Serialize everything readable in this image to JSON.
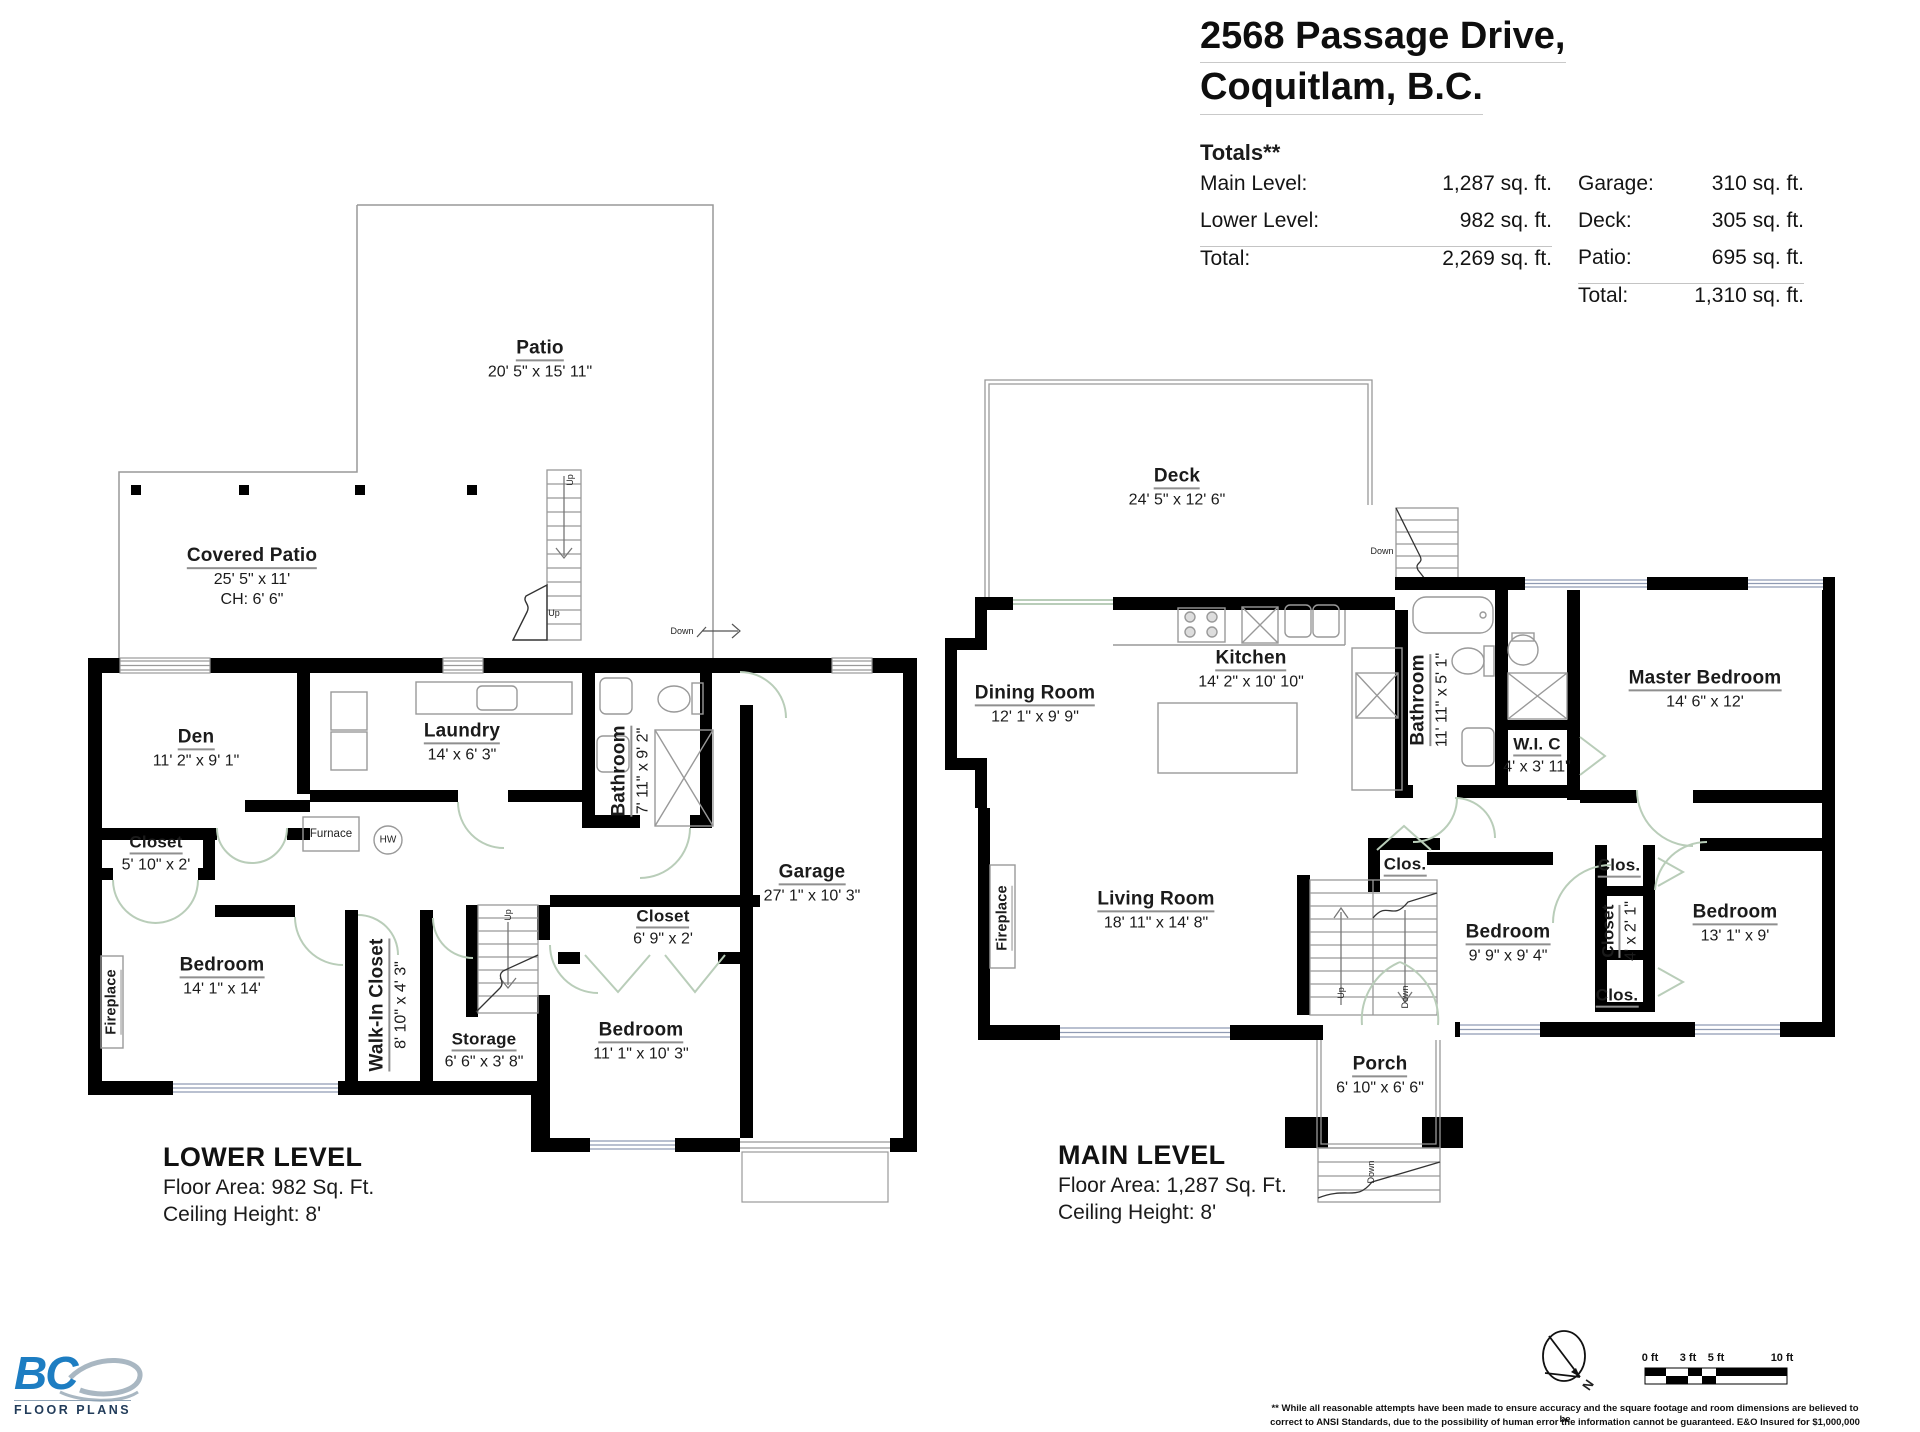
{
  "header": {
    "title_line1": "2568 Passage Drive,",
    "title_line2": "Coquitlam, B.C.",
    "totals_heading": "Totals**",
    "left_rows": [
      {
        "label": "Main Level:",
        "value": "1,287 sq. ft."
      },
      {
        "label": "Lower Level:",
        "value": "982 sq. ft."
      },
      {
        "label": "Total:",
        "value": "2,269 sq. ft."
      }
    ],
    "right_rows": [
      {
        "label": "Garage:",
        "value": "310 sq. ft."
      },
      {
        "label": "Deck:",
        "value": "305 sq. ft."
      },
      {
        "label": "Patio:",
        "value": "695 sq. ft."
      },
      {
        "label": "Total:",
        "value": "1,310 sq. ft."
      }
    ]
  },
  "labels": {
    "up": "Up",
    "down": "Down"
  },
  "lower_level": {
    "patio": {
      "name": "Patio",
      "dims": "20' 5\" x 15' 11\""
    },
    "covered_patio": {
      "name": "Covered Patio",
      "dims": "25' 5\" x 11'",
      "ceiling": "CH: 6' 6\""
    },
    "den": {
      "name": "Den",
      "dims": "11' 2\" x 9' 1\""
    },
    "closet": {
      "name": "Closet",
      "dims": "5' 10\" x 2'"
    },
    "laundry": {
      "name": "Laundry",
      "dims": "14' x 6' 3\""
    },
    "bathroom": {
      "name": "Bathroom",
      "dims": "7' 11\" x 9' 2\""
    },
    "furnace": "Furnace",
    "hot_water": "HW",
    "fireplace": "Fireplace",
    "bedroom1": {
      "name": "Bedroom",
      "dims": "14' 1\" x 14'"
    },
    "walk_in_closet": {
      "name": "Walk-In Closet",
      "dims": "8' 10\" x 4' 3\""
    },
    "storage": {
      "name": "Storage",
      "dims": "6' 6\" x 3' 8\""
    },
    "bedroom2": {
      "name": "Bedroom",
      "dims": "11' 1\" x 10' 3\""
    },
    "closet2": {
      "name": "Closet",
      "dims": "6' 9\" x 2'"
    },
    "garage": {
      "name": "Garage",
      "dims": "27' 1\" x 10' 3\""
    },
    "footer": {
      "title": "LOWER LEVEL",
      "area": "Floor Area: 982 Sq. Ft.",
      "ceiling": "Ceiling Height: 8'"
    }
  },
  "main_level": {
    "deck": {
      "name": "Deck",
      "dims": "24' 5\" x 12' 6\""
    },
    "dining_room": {
      "name": "Dining Room",
      "dims": "12' 1\" x 9' 9\""
    },
    "kitchen": {
      "name": "Kitchen",
      "dims": "14' 2\" x 10' 10\""
    },
    "bathroom": {
      "name": "Bathroom",
      "dims": "11' 11\" x 5' 1\""
    },
    "wic": {
      "name": "W.I. C",
      "dims": "4' x 3' 11\""
    },
    "master_bedroom": {
      "name": "Master Bedroom",
      "dims": "14' 6\" x 12'"
    },
    "living_room": {
      "name": "Living Room",
      "dims": "18' 11\" x 14' 8\""
    },
    "fireplace": "Fireplace",
    "clos": "Clos.",
    "closet": {
      "name": "Closet",
      "dims": "4' x 2' 1\""
    },
    "bedroom1": {
      "name": "Bedroom",
      "dims": "9' 9\" x 9' 4\""
    },
    "bedroom2": {
      "name": "Bedroom",
      "dims": "13' 1\" x 9'"
    },
    "porch": {
      "name": "Porch",
      "dims": "6' 10\" x 6' 6\""
    },
    "footer": {
      "title": "MAIN LEVEL",
      "area": "Floor Area: 1,287 Sq. Ft.",
      "ceiling": "Ceiling Height: 8'"
    }
  },
  "footer": {
    "logo": {
      "bc": "BC",
      "text": "FLOOR PLANS"
    },
    "north": "N",
    "scale": {
      "t0": "0 ft",
      "t3": "3 ft",
      "t5": "5 ft",
      "t10": "10 ft"
    },
    "disclaimer1": "** While all reasonable attempts have been made to ensure accuracy and the square footage and room dimensions are believed to be",
    "disclaimer2": "correct to ANSI Standards, due to the possibility of human error the information cannot be guaranteed. E&O Insured for $1,000,000"
  },
  "colors": {
    "wall": "#000000",
    "thin_line": "#999999",
    "door_arc": "#b9cdb9",
    "window_line": "#8f9bb3",
    "logo_blue": "#1d7dc2"
  }
}
